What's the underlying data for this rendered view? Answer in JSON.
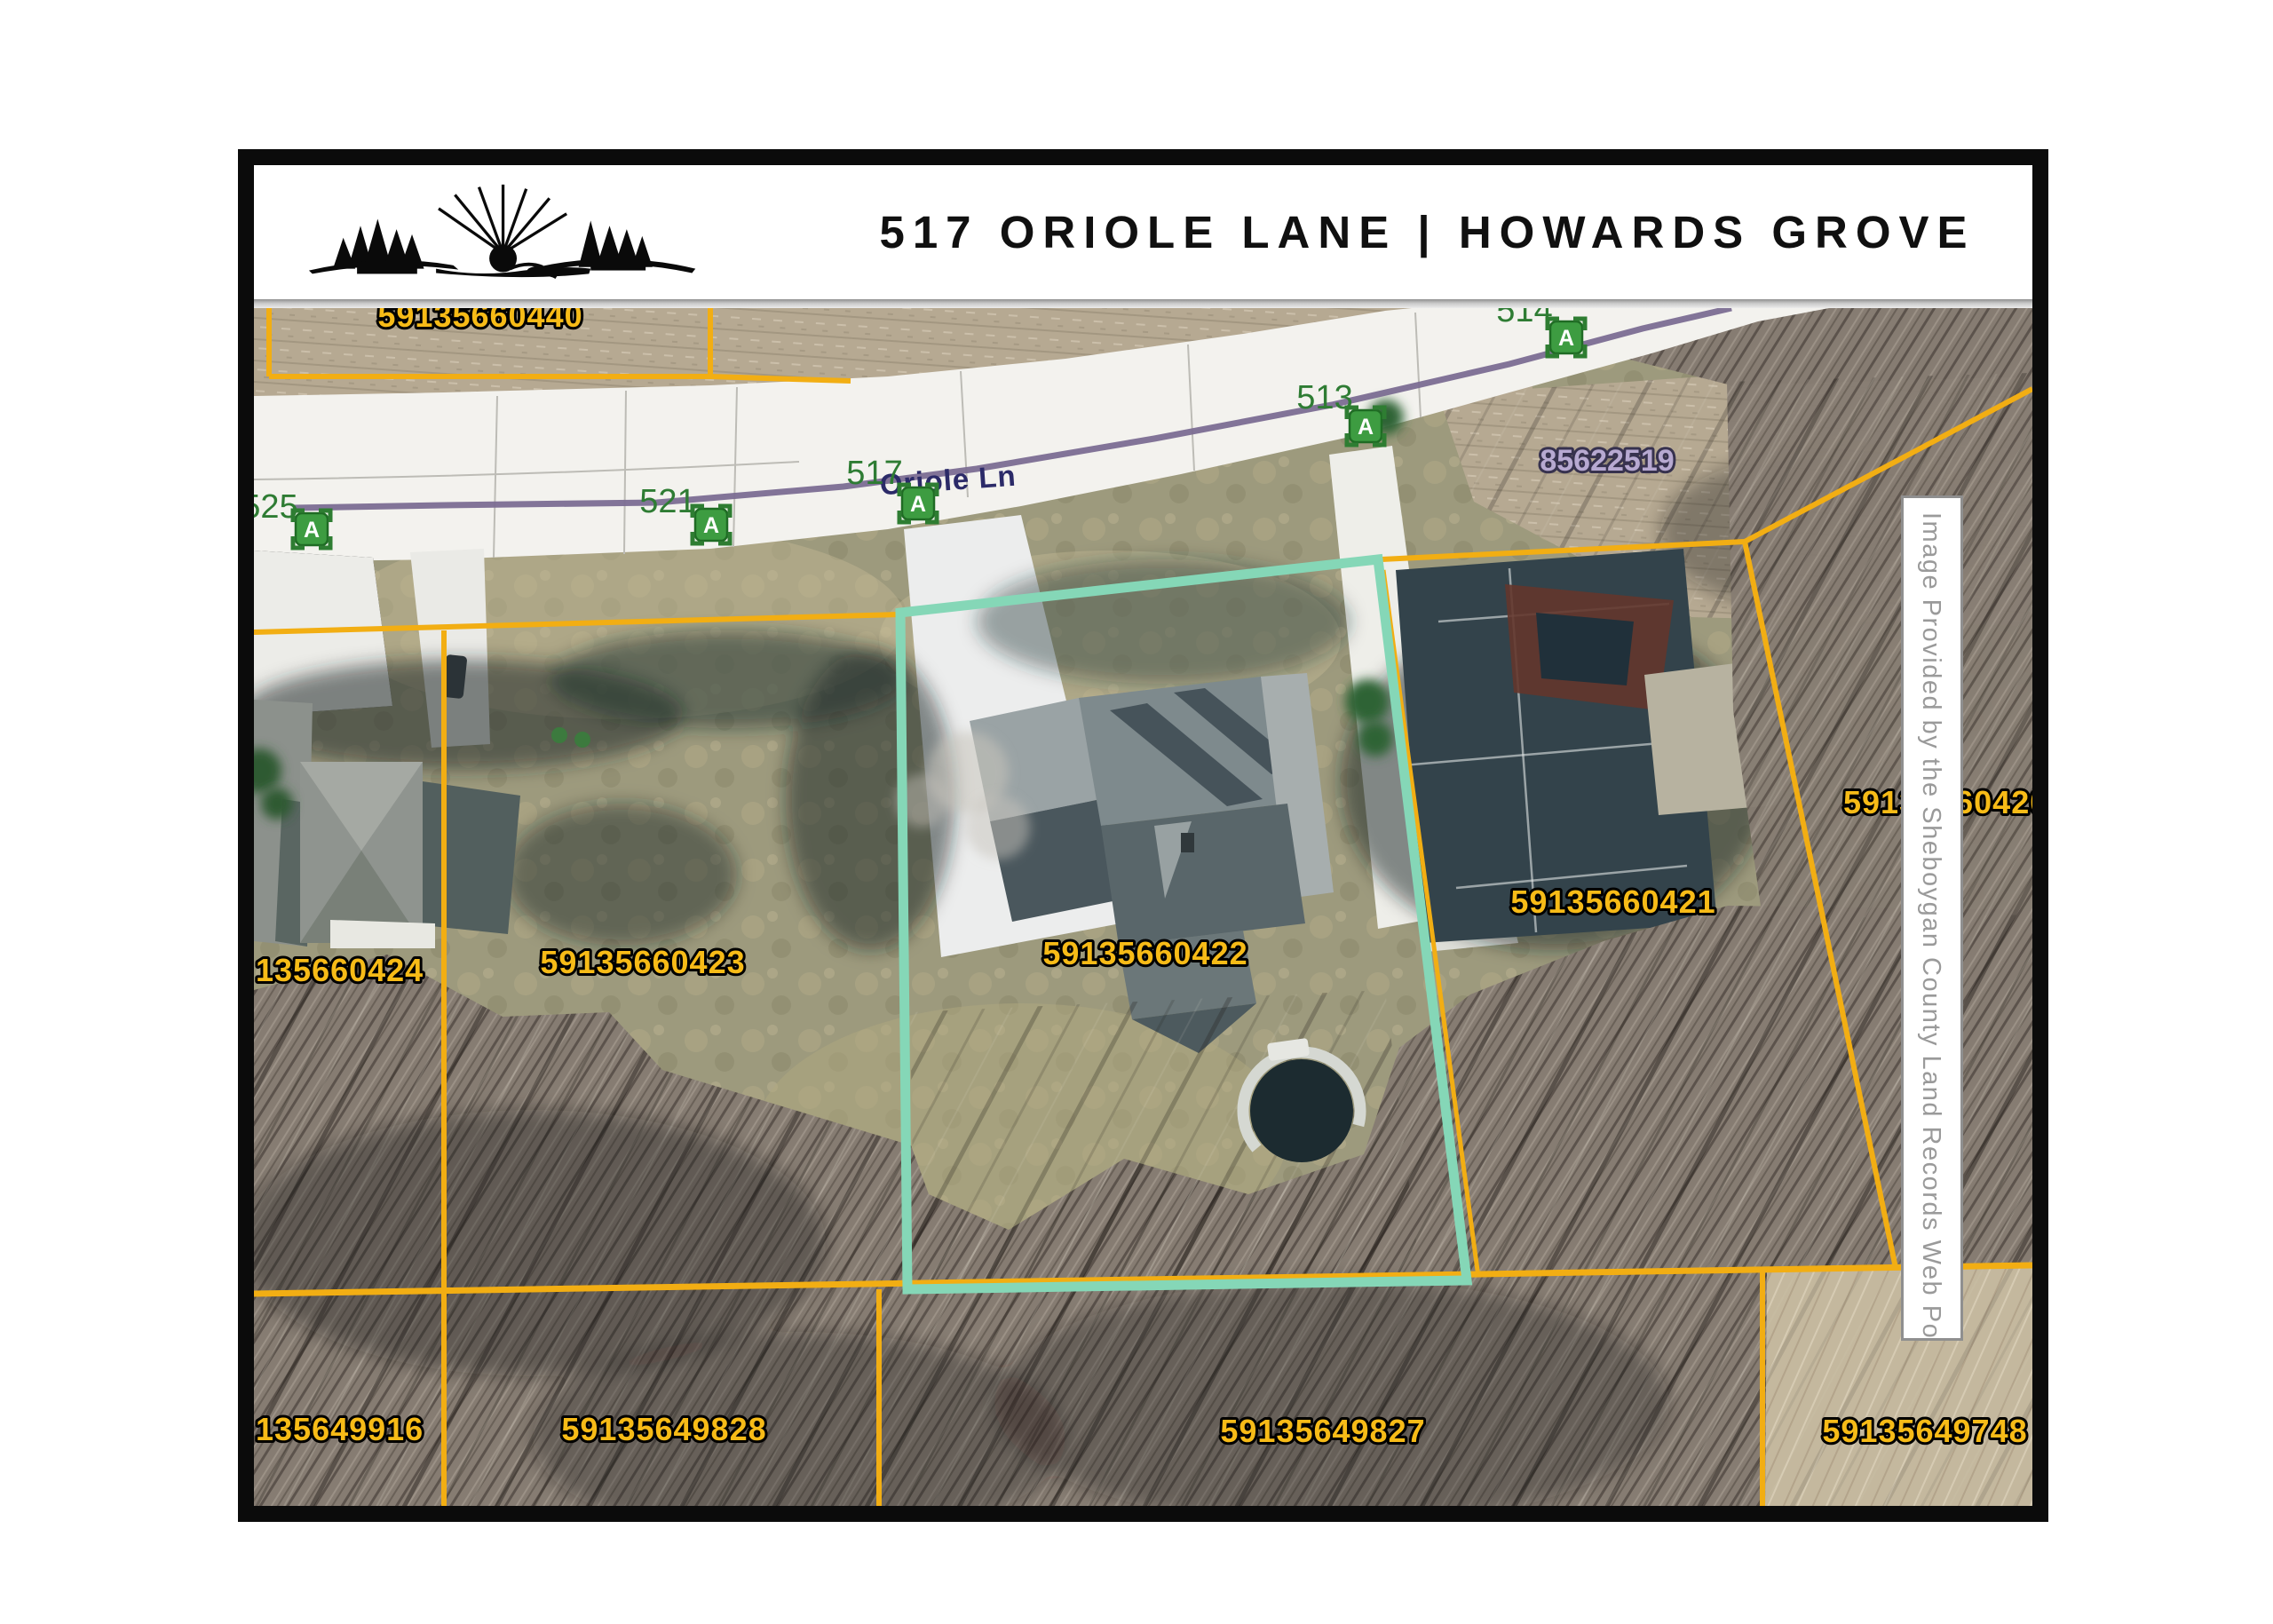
{
  "header": {
    "title": "517 ORIOLE LANE | HOWARDS GROVE"
  },
  "logo": {
    "name": "pine-trees-sunrise-logo"
  },
  "map": {
    "street_label": "Oriole Ln",
    "credit": "Image Provided by the Sheboygan County Land Records Web Portal",
    "marker_letter": "A",
    "highlighted_parcel": "59135660422",
    "colors": {
      "parcel_line": "#f2ae13",
      "parcel_label": "#f7bb17",
      "highlight_outline": "#85d7b7",
      "road_centerline": "#7b6d92",
      "house_number": "#2e7c33",
      "alt_parcel_label": "#b7a9d1"
    },
    "parcels": [
      {
        "id": "59135660440"
      },
      {
        "id": "135660424"
      },
      {
        "id": "59135660423"
      },
      {
        "id": "59135660422"
      },
      {
        "id": "59135660421"
      },
      {
        "id": "59135660420"
      },
      {
        "id": "85622519"
      },
      {
        "id": "135649916"
      },
      {
        "id": "59135649828"
      },
      {
        "id": "59135649827"
      },
      {
        "id": "59135649748"
      }
    ],
    "house_numbers": [
      {
        "n": "525"
      },
      {
        "n": "521"
      },
      {
        "n": "517"
      },
      {
        "n": "513"
      },
      {
        "n": "514"
      }
    ]
  }
}
